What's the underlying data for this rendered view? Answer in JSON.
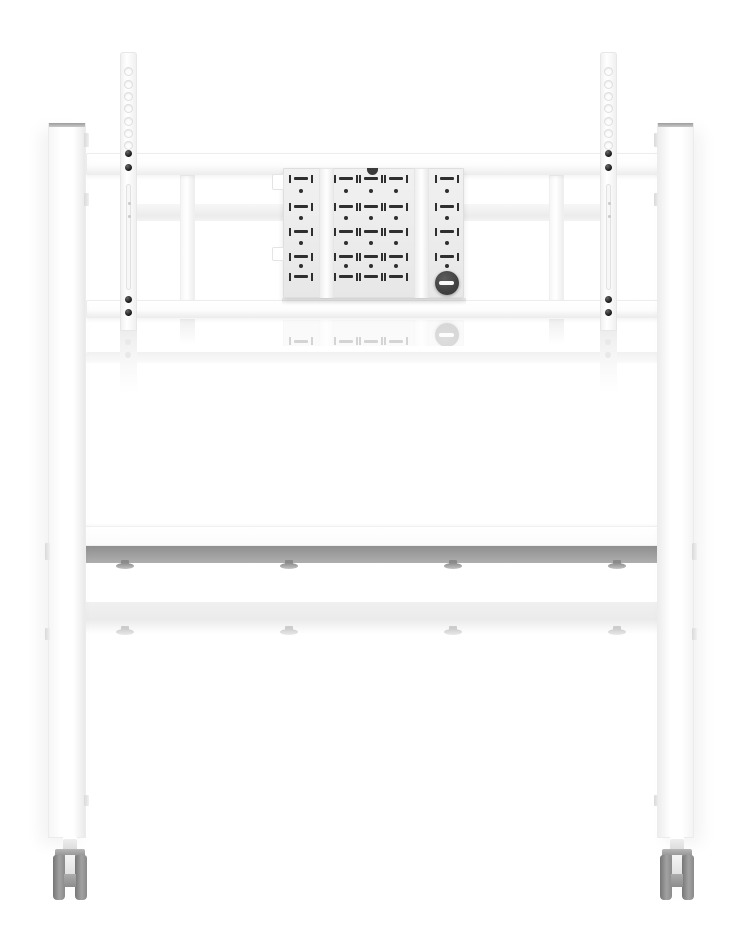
{
  "colors": {
    "background": "#ffffff",
    "metal_white": "#ffffff",
    "edge_gray": "#e8e8e8",
    "panel_gray": "#efefef",
    "perforation_dark": "#2f2f2f",
    "knob_dark": "#454545",
    "knob_slot_white": "#fafafa",
    "shelf_underside_gray": "#9e9e9e",
    "caster_gray": "#8f8f8f",
    "leg_cap_gray": "#a8a8a8",
    "reflection_gray": "#f1f1f1"
  },
  "brackets": {
    "hole_offsets": [
      18,
      31,
      43,
      55,
      68,
      80,
      92
    ],
    "screw_offsets": [
      100,
      114,
      246,
      259
    ],
    "slot_top": 131,
    "slot_height": 106,
    "slot_dot_offsets": [
      148,
      161
    ]
  },
  "plate": {
    "dividers_x": [
      35,
      130
    ],
    "notch": {
      "cx": 88,
      "w": 11
    },
    "tabs": [
      {
        "y": 5,
        "h": 16
      },
      {
        "y": 78,
        "h": 14
      }
    ],
    "slot_rows": [
      9,
      37,
      62,
      87,
      107
    ],
    "dot_rows": [
      22,
      49,
      74,
      97
    ],
    "columns": [
      {
        "name": "left-panel",
        "centers": [
          17
        ]
      },
      {
        "name": "center-panel",
        "centers": [
          62,
          87,
          112
        ]
      },
      {
        "name": "right-panel",
        "centers": [
          163
        ],
        "slot_rows": [
          0,
          1,
          2,
          3
        ],
        "dot_rows": [
          0,
          1,
          2,
          3
        ]
      }
    ],
    "knob": {
      "cx": 163,
      "cy": 114,
      "r": 12
    }
  },
  "shelf": {
    "feet_x": [
      125,
      289,
      453,
      617
    ]
  },
  "legs": {
    "inner_clips": [
      {
        "y": 10,
        "h": 14
      },
      {
        "y": 70,
        "h": 13
      },
      {
        "y": 672,
        "h": 11
      }
    ],
    "outer_clips": [
      {
        "y": 420,
        "h": 17
      },
      {
        "y": 505,
        "h": 12
      }
    ]
  }
}
